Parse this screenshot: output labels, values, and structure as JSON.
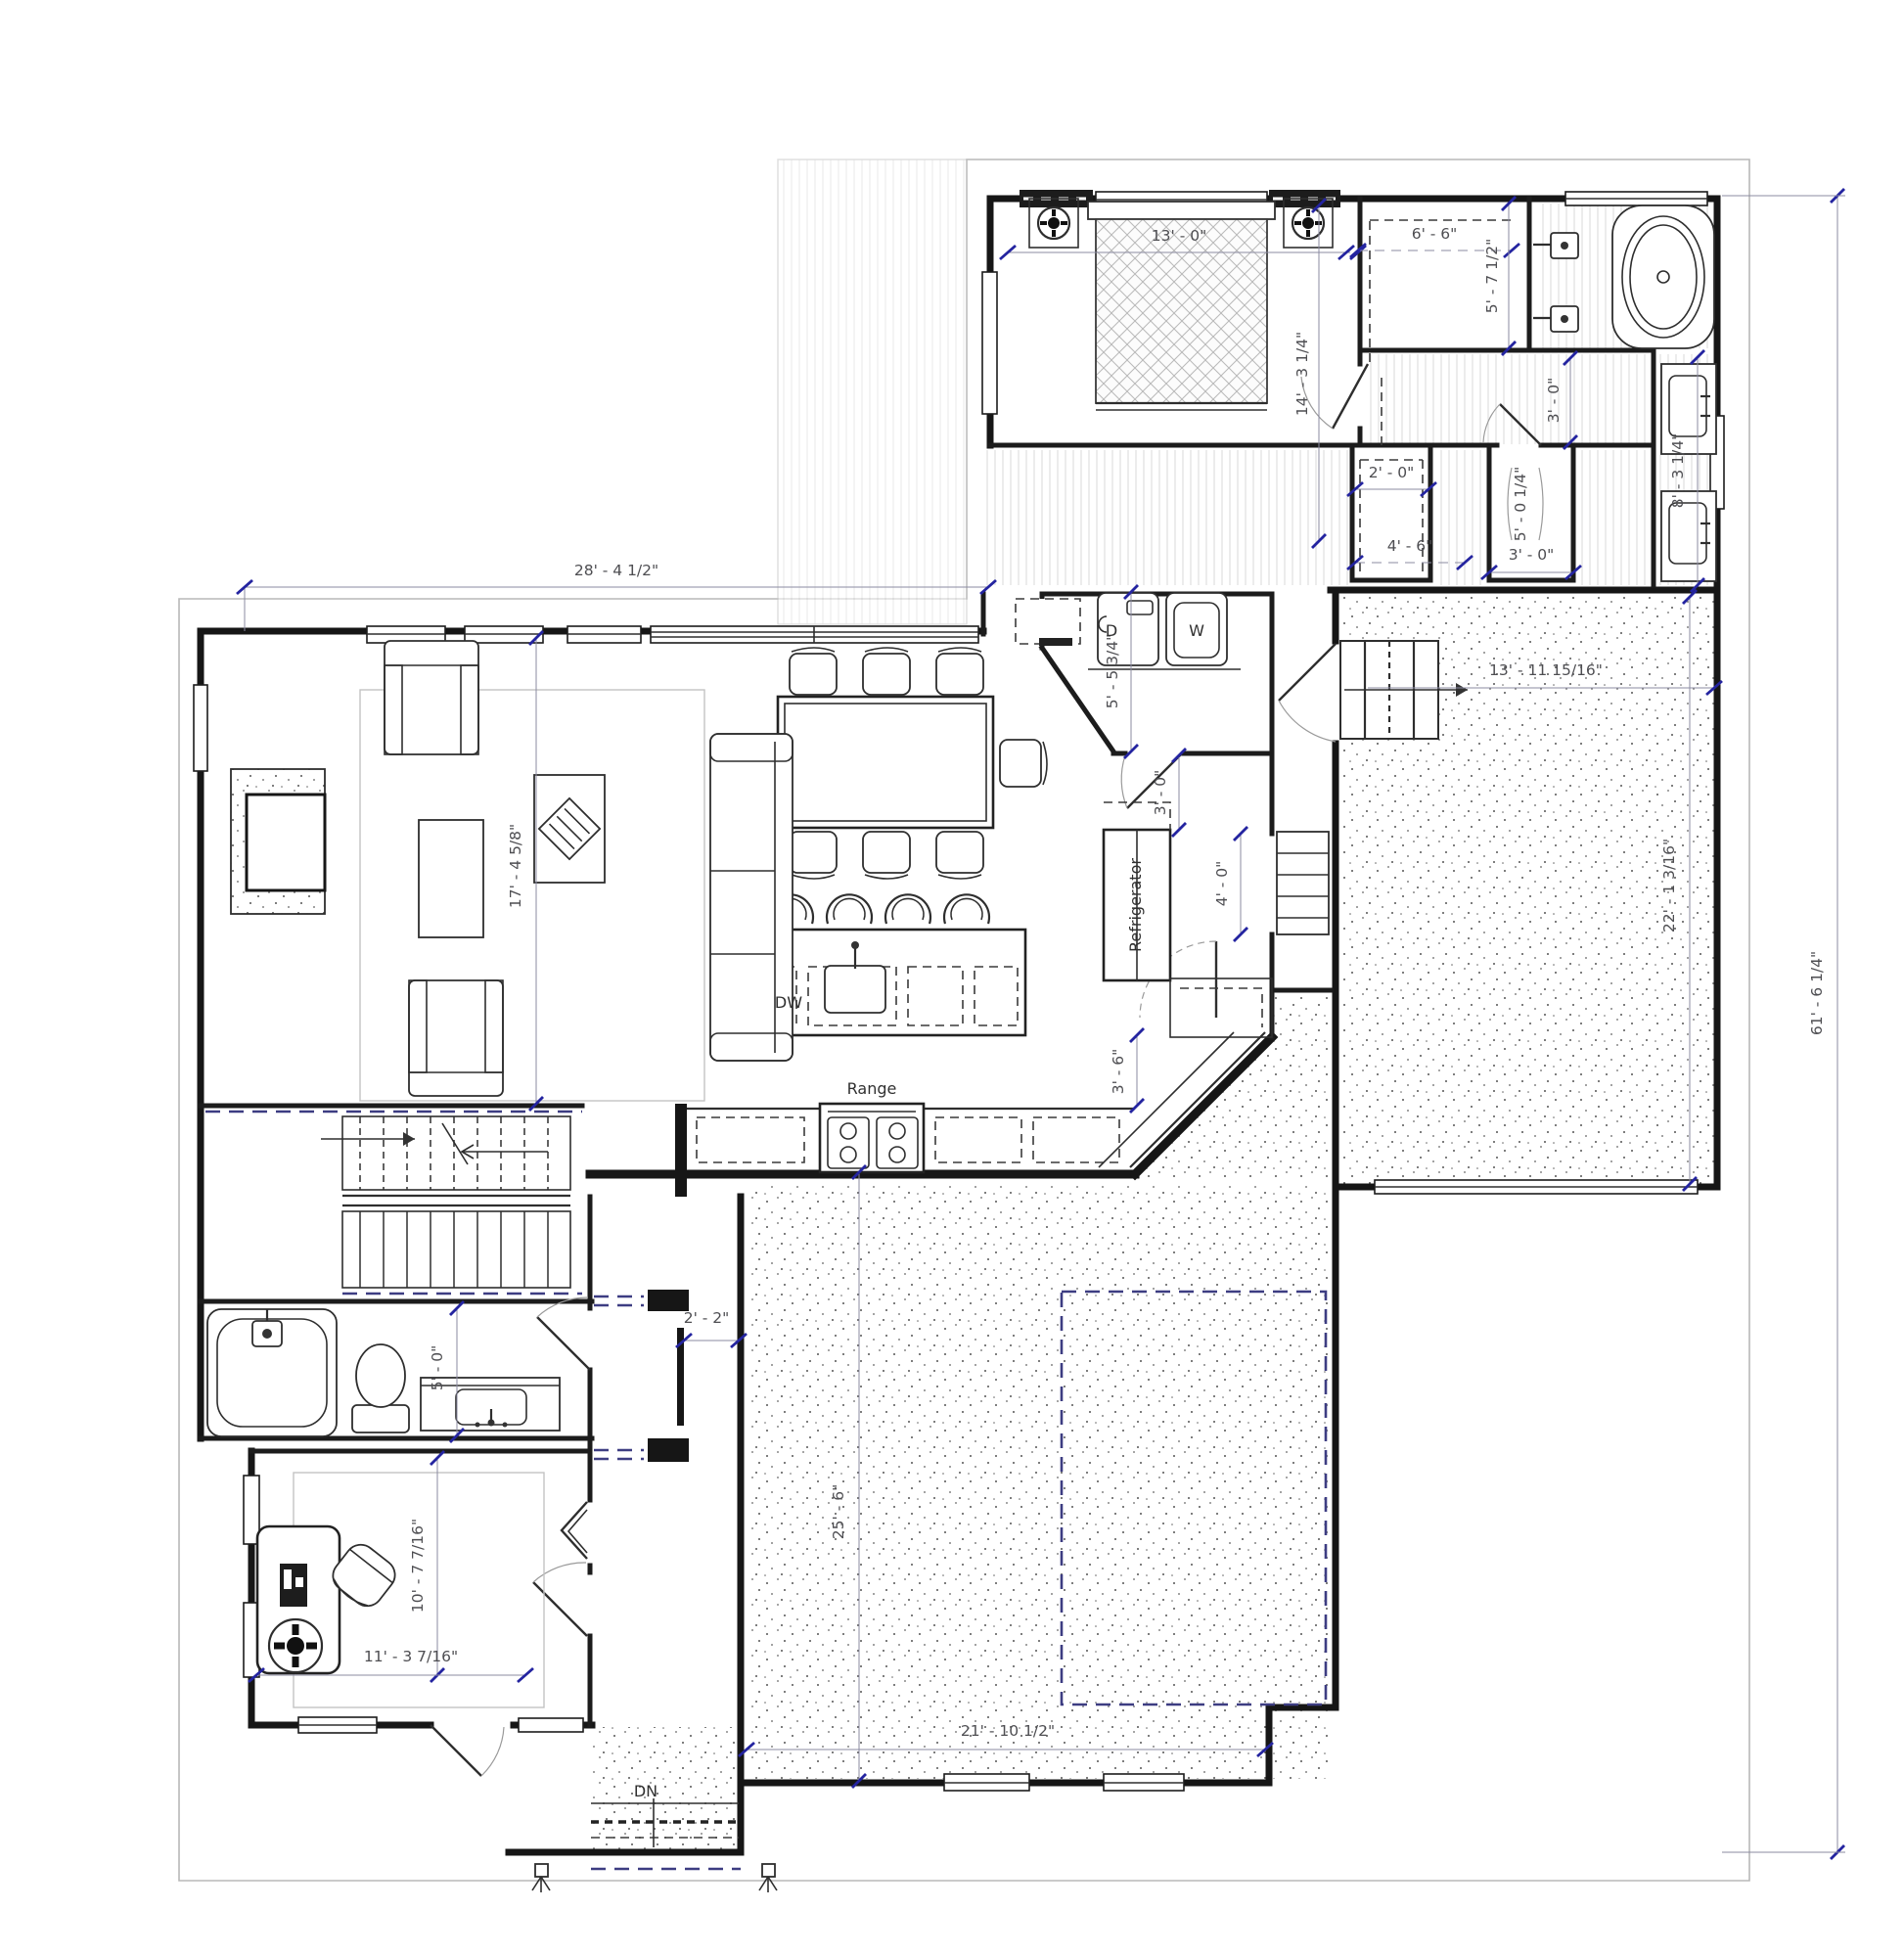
{
  "document": {
    "kind": "architectural-floor-plan",
    "level": "main-level"
  },
  "labels": {
    "range": "Range",
    "refrigerator": "Refrigerator",
    "dishwasher": "DW",
    "dryer": "D",
    "washer": "W",
    "down": "DN"
  },
  "dims": {
    "bed_width": "13' - 0\"",
    "bed_depth": "14' - 3 1/4\"",
    "wic": "6' - 6\"",
    "bath_width": "5' - 7 1/2\"",
    "door3a": "3' - 0\"",
    "closet2": "2' - 0\"",
    "closet45": "4' - 6\"",
    "wc_len": "5' - 0 1/4\"",
    "wc_wid": "3' - 0\"",
    "vanity_run": "8' - 3 1/4\"",
    "living_w": "28' - 4 1/2\"",
    "laundry_d": "5' - 5 3/4\"",
    "hall3": "3' - 0\"",
    "garage1_w": "13' - 11 15/16\"",
    "garage1_d": "22' - 1 3/16\"",
    "overall_d": "61' - 6 1/4\"",
    "living_d": "17' - 4 5/8\"",
    "pantry_hall": "4' - 0\"",
    "aisle": "3' - 6\"",
    "niche": "2' - 2\"",
    "bath2_w": "5' - 0\"",
    "garage2_d": "25' - 6\"",
    "office_d": "10' - 7 7/16\"",
    "office_w": "11' - 3 7/16\"",
    "garage2_w": "21' - 10 1/2\""
  },
  "colors": {
    "walls": "#161616",
    "dimension_line": "#8b8ba2",
    "dimension_tick": "#2424a0",
    "ceiling_dash": "#3d3d82",
    "roof_outline": "#b8b8b8",
    "text": "#4e4e52",
    "background": "#ffffff"
  }
}
